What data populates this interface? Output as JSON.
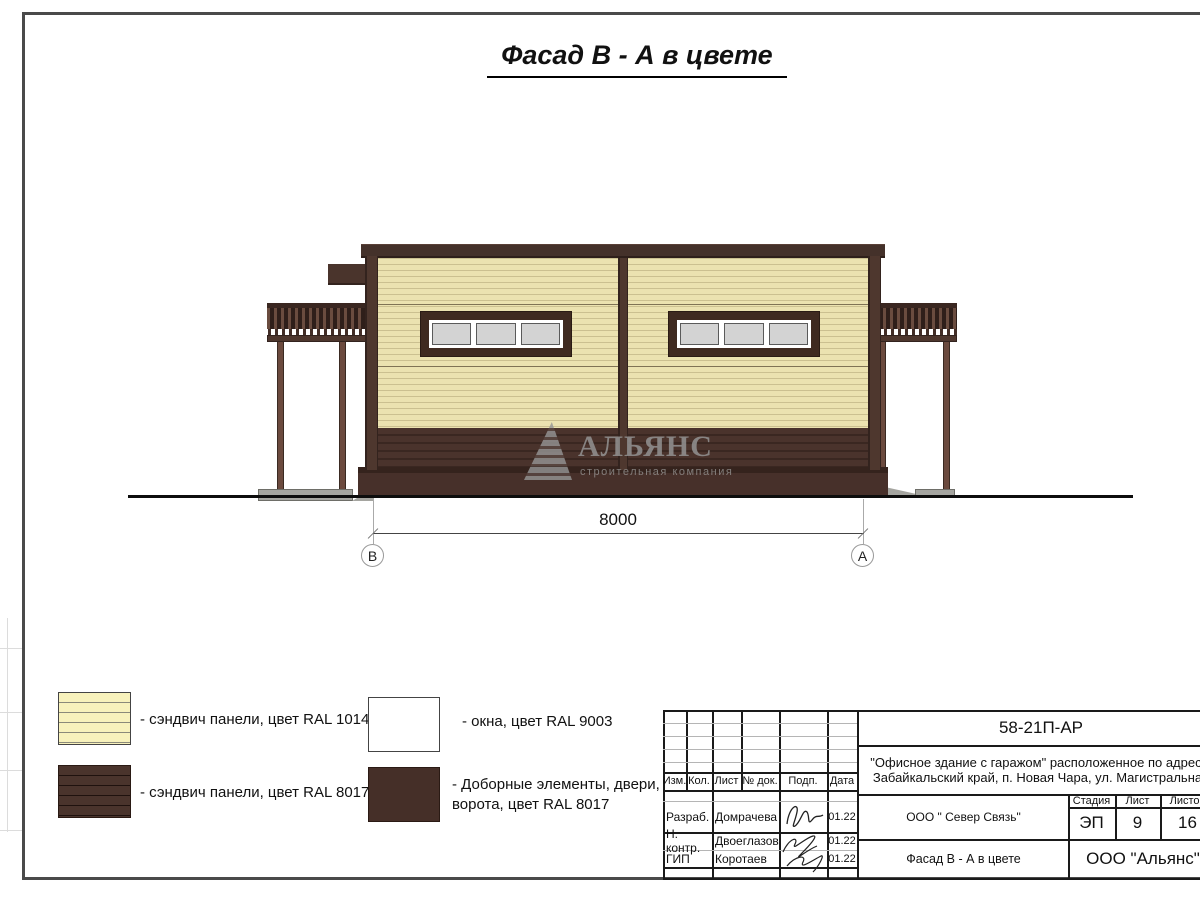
{
  "page": {
    "title": "Фасад В - А в цвете"
  },
  "drawing": {
    "dimension": {
      "value": "8000",
      "axis_left": "В",
      "axis_right": "А"
    },
    "watermark": {
      "name": "АЛЬЯНС",
      "subtitle": "строительная компания"
    },
    "colors": {
      "panel_yellow": "#EBE2B0",
      "panel_brown": "#4A332C",
      "trim_brown": "#3F2A20",
      "window_gray": "#D3D3D3",
      "concrete_gray": "#A5A5A0"
    }
  },
  "legend": {
    "items": [
      {
        "swatch": "panel-yellow-swatch",
        "label": "- сэндвич панели, цвет RAL 1014"
      },
      {
        "swatch": "window-white-swatch",
        "label": "- окна, цвет RAL 9003"
      },
      {
        "swatch": "panel-brown-swatch",
        "label": "- сэндвич панели, цвет RAL 8017"
      },
      {
        "swatch": "elements-brown-swatch",
        "label": "- Доборные элементы, двери, ворота, цвет RAL 8017"
      }
    ]
  },
  "title_block": {
    "doc_number": "58-21П-АР",
    "project_line1": "\"Офисное здание с гаражом\" расположенное по адресу:",
    "project_line2": "Забайкальский край, п. Новая Чара, ул. Магистральная",
    "organization": "ООО \" Север Связь\"",
    "drawing_title": "Фасад В - А в цвете",
    "company": "ООО \"Альянс\"",
    "columns": {
      "izm": "Изм.",
      "kol": "Кол.",
      "list": "Лист",
      "doc": "№ док.",
      "podp": "Подп.",
      "data": "Дата"
    },
    "stage": {
      "header": "Стадия",
      "value": "ЭП"
    },
    "sheet": {
      "header": "Лист",
      "value": "9"
    },
    "sheets": {
      "header": "Листов",
      "value": "16"
    },
    "rows": [
      {
        "role": "Разраб.",
        "name": "Домрачева",
        "date": "01.22"
      },
      {
        "role": "Н. контр.",
        "name": "Двоеглазов",
        "date": "01.22"
      },
      {
        "role": "ГИП",
        "name": "Коротаев",
        "date": "01.22"
      }
    ]
  }
}
